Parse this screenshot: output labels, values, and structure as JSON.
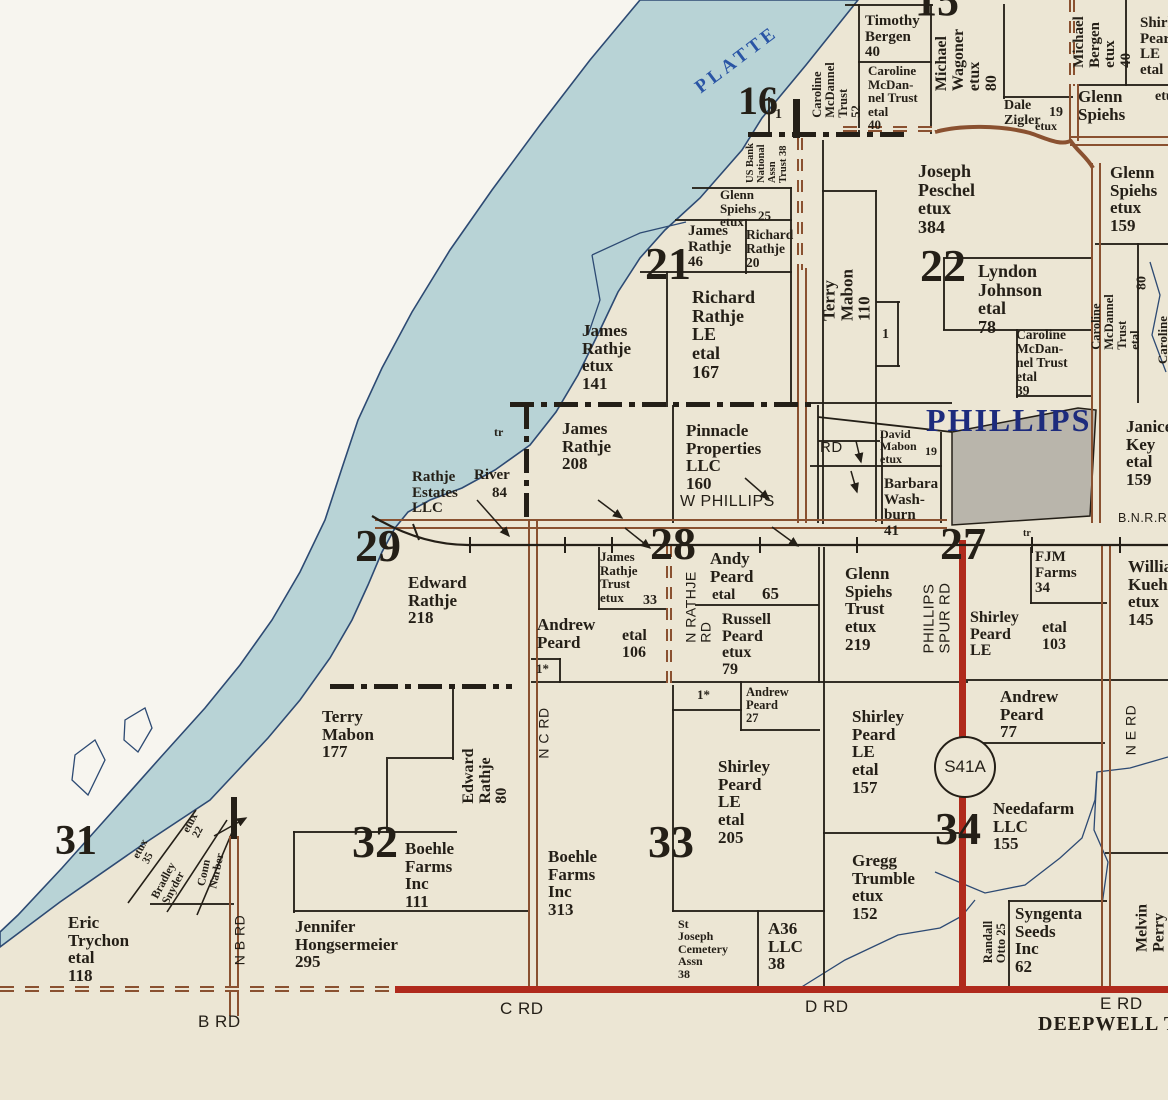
{
  "colors": {
    "paper": "#ece6d4",
    "margin": "#f7f5ef",
    "river": "#b8d3d6",
    "river-edge": "#2d4a73",
    "ink": "#241f17",
    "brown": "#8a5130",
    "red": "#b02a1c",
    "town": "#b9b5ab",
    "navy": "#1d2b7d",
    "platte": "#2a55a5"
  },
  "highway_shield": {
    "label": "S41A"
  },
  "river_name": "PLATTE",
  "town_name": "PHILLIPS",
  "railroad_label": "B.N.R.R.",
  "township_label": "DEEPWELL TW",
  "labels": [
    {
      "n": "river-name-platte",
      "t": "PLATTE",
      "x": 737,
      "y": 60,
      "fs": 19,
      "r": -37,
      "ls": 4,
      "c": "#2a55a5"
    },
    {
      "n": "town-name-phillips",
      "t": "PHILLIPS",
      "x": 926,
      "y": 404,
      "fs": 32,
      "ls": 2,
      "c": "#1d2b7d"
    },
    {
      "n": "railroad-label",
      "t": "B.N.R.R.",
      "x": 1118,
      "y": 512,
      "fs": 12.5,
      "f": "sans"
    },
    {
      "n": "section-number-15",
      "t": "15",
      "x": 915,
      "y": -22,
      "fs": 44
    },
    {
      "n": "section-number-16",
      "t": "16",
      "x": 738,
      "y": 80,
      "fs": 40
    },
    {
      "n": "section-number-21",
      "t": "21",
      "x": 645,
      "y": 240,
      "fs": 46
    },
    {
      "n": "section-number-22",
      "t": "22",
      "x": 920,
      "y": 242,
      "fs": 46
    },
    {
      "n": "section-number-27",
      "t": "27",
      "x": 940,
      "y": 520,
      "fs": 46
    },
    {
      "n": "section-number-28",
      "t": "28",
      "x": 650,
      "y": 520,
      "fs": 46
    },
    {
      "n": "section-number-29",
      "t": "29",
      "x": 355,
      "y": 522,
      "fs": 46
    },
    {
      "n": "section-number-31",
      "t": "31",
      "x": 55,
      "y": 820,
      "fs": 42
    },
    {
      "n": "section-number-32",
      "t": "32",
      "x": 352,
      "y": 818,
      "fs": 46
    },
    {
      "n": "section-number-33",
      "t": "33",
      "x": 648,
      "y": 818,
      "fs": 46
    },
    {
      "n": "section-number-34",
      "t": "34",
      "x": 935,
      "y": 805,
      "fs": 46
    },
    {
      "t": "Timothy\nBergen\n40",
      "x": 865,
      "y": 14,
      "fs": 15
    },
    {
      "t": "Caroline\nMcDan-\nnel Trust\netal\n40",
      "x": 868,
      "y": 64,
      "fs": 13
    },
    {
      "t": "Michael\nWagoner\netux\n80",
      "x": 967,
      "y": 60,
      "fs": 16,
      "r": -90
    },
    {
      "t": "Dale\nZigler",
      "x": 1004,
      "y": 99,
      "fs": 14
    },
    {
      "t": "19",
      "x": 1049,
      "y": 106,
      "fs": 14
    },
    {
      "t": "etux",
      "x": 1035,
      "y": 120,
      "fs": 12
    },
    {
      "t": "Michael\nBergen\netux\n40",
      "x": 1103,
      "y": 42,
      "fs": 15,
      "r": -90
    },
    {
      "t": "Shirley\nPeard\nLE\netal",
      "x": 1140,
      "y": 16,
      "fs": 15
    },
    {
      "t": "Glenn\nSpiehs",
      "x": 1078,
      "y": 88,
      "fs": 17
    },
    {
      "t": "etux",
      "x": 1155,
      "y": 90,
      "fs": 14
    },
    {
      "t": "Caroline\nMcDannel\nTrust\n52",
      "x": 837,
      "y": 90,
      "fs": 12.5,
      "r": -90
    },
    {
      "t": "US Bank\nNational\nAssn\nTrust 38",
      "x": 768,
      "y": 163,
      "fs": 10.5,
      "r": -90
    },
    {
      "t": "1",
      "x": 775,
      "y": 108,
      "fs": 14
    },
    {
      "t": "Glenn\nSpiehs\netux",
      "x": 720,
      "y": 188,
      "fs": 13
    },
    {
      "t": "25",
      "x": 758,
      "y": 209,
      "fs": 13
    },
    {
      "t": "James\nRathje\n46",
      "x": 688,
      "y": 224,
      "fs": 15
    },
    {
      "t": "Richard\nRathje\n20",
      "x": 746,
      "y": 228,
      "fs": 13.5
    },
    {
      "t": "Terry\nMabon\n110",
      "x": 847,
      "y": 295,
      "fs": 17,
      "r": -90
    },
    {
      "t": "1",
      "x": 882,
      "y": 328,
      "fs": 14
    },
    {
      "t": "Joseph\nPeschel\netux\n384",
      "x": 918,
      "y": 162,
      "fs": 18
    },
    {
      "t": "Glenn\nSpiehs\netux\n159",
      "x": 1110,
      "y": 164,
      "fs": 17
    },
    {
      "t": "Lyndon\nJohnson\netal\n78",
      "x": 978,
      "y": 262,
      "fs": 18
    },
    {
      "t": "Caroline\nMcDan-\nnel Trust\netal\n39",
      "x": 1016,
      "y": 328,
      "fs": 13.5
    },
    {
      "t": "Caroline\nMcDannel\nTrust\netal",
      "x": 1116,
      "y": 322,
      "fs": 12.5,
      "r": -90
    },
    {
      "t": "80",
      "x": 1143,
      "y": 283,
      "fs": 14,
      "r": -90
    },
    {
      "t": "Caroline",
      "x": 1163,
      "y": 340,
      "fs": 13,
      "r": -90
    },
    {
      "t": "Richard\nRathje\nLE\netal\n167",
      "x": 692,
      "y": 288,
      "fs": 18
    },
    {
      "t": "James\nRathje\netux\n141",
      "x": 582,
      "y": 322,
      "fs": 17
    },
    {
      "t": "James\nRathje\n208",
      "x": 562,
      "y": 420,
      "fs": 17
    },
    {
      "t": "Pinnacle\nProperties\nLLC\n160",
      "x": 686,
      "y": 422,
      "fs": 17
    },
    {
      "t": "W PHILLIPS",
      "x": 680,
      "y": 494,
      "fs": 16,
      "f": "sans"
    },
    {
      "t": "tr",
      "x": 494,
      "y": 426,
      "fs": 12
    },
    {
      "t": "tr",
      "x": 1023,
      "y": 529,
      "fs": 10
    },
    {
      "t": "RD",
      "x": 820,
      "y": 440,
      "fs": 15,
      "f": "sans"
    },
    {
      "t": "David\nMabon\netux",
      "x": 880,
      "y": 428,
      "fs": 12
    },
    {
      "t": "19",
      "x": 925,
      "y": 445,
      "fs": 12
    },
    {
      "t": "Barbara\nWash-\nburn\n41",
      "x": 884,
      "y": 477,
      "fs": 15
    },
    {
      "t": "Janice\nKey\netal\n159",
      "x": 1126,
      "y": 418,
      "fs": 17
    },
    {
      "t": "Rathje\nEstates\nLLC",
      "x": 412,
      "y": 470,
      "fs": 15
    },
    {
      "t": "River",
      "x": 474,
      "y": 468,
      "fs": 15
    },
    {
      "t": "84",
      "x": 492,
      "y": 486,
      "fs": 15
    },
    {
      "t": "Edward\nRathje\n218",
      "x": 408,
      "y": 574,
      "fs": 17
    },
    {
      "t": "James\nRathje\nTrust\netux",
      "x": 600,
      "y": 550,
      "fs": 13
    },
    {
      "t": "33",
      "x": 643,
      "y": 594,
      "fs": 14
    },
    {
      "t": "N RATHJE\nRD",
      "x": 698,
      "y": 607,
      "fs": 14,
      "f": "sans",
      "r": -90
    },
    {
      "t": "Andy\nPeard",
      "x": 710,
      "y": 550,
      "fs": 17
    },
    {
      "t": "etal",
      "x": 712,
      "y": 588,
      "fs": 15
    },
    {
      "t": "65",
      "x": 762,
      "y": 585,
      "fs": 17
    },
    {
      "t": "Russell\nPeard\netux\n79",
      "x": 722,
      "y": 612,
      "fs": 16
    },
    {
      "t": "Andrew\nPeard",
      "x": 537,
      "y": 616,
      "fs": 17
    },
    {
      "t": "etal\n106",
      "x": 622,
      "y": 628,
      "fs": 16
    },
    {
      "t": "1*",
      "x": 536,
      "y": 662,
      "fs": 13
    },
    {
      "t": "Glenn\nSpiehs\nTrust\netux\n219",
      "x": 845,
      "y": 565,
      "fs": 17
    },
    {
      "t": "PHILLIPS\nSPUR RD",
      "x": 937,
      "y": 618,
      "fs": 15,
      "f": "sans",
      "r": -90
    },
    {
      "t": "Shirley\nPeard\nLE",
      "x": 970,
      "y": 610,
      "fs": 16
    },
    {
      "t": "etal\n103",
      "x": 1042,
      "y": 620,
      "fs": 16
    },
    {
      "t": "FJM\nFarms\n34",
      "x": 1035,
      "y": 550,
      "fs": 15
    },
    {
      "t": "William\nKuehner\netux\n145",
      "x": 1128,
      "y": 558,
      "fs": 17
    },
    {
      "t": "Terry\nMabon\n177",
      "x": 322,
      "y": 708,
      "fs": 17
    },
    {
      "t": "Edward\nRathje\n80",
      "x": 486,
      "y": 776,
      "fs": 16,
      "r": -90
    },
    {
      "t": "N C RD",
      "x": 544,
      "y": 733,
      "fs": 14,
      "f": "sans",
      "r": -90
    },
    {
      "t": "Boehle\nFarms\nInc\n111",
      "x": 405,
      "y": 840,
      "fs": 17
    },
    {
      "t": "Jennifer\nHongsermeier\n295",
      "x": 295,
      "y": 918,
      "fs": 17
    },
    {
      "t": "Eric\nTrychon\netal\n118",
      "x": 68,
      "y": 914,
      "fs": 17
    },
    {
      "t": "etux\n35",
      "x": 146,
      "y": 852,
      "fs": 11,
      "r": -62
    },
    {
      "t": "Bradley\nSnyder",
      "x": 170,
      "y": 884,
      "fs": 11.5,
      "r": -62
    },
    {
      "t": "etux\n22",
      "x": 196,
      "y": 826,
      "fs": 11,
      "r": -62
    },
    {
      "t": "Conn\nNarber",
      "x": 212,
      "y": 870,
      "fs": 11.5,
      "r": -78
    },
    {
      "t": "N B RD",
      "x": 240,
      "y": 940,
      "fs": 14,
      "f": "sans",
      "r": -90
    },
    {
      "n": "road-label-b-rd",
      "t": "B RD",
      "x": 198,
      "y": 1013,
      "fs": 17,
      "f": "sans"
    },
    {
      "t": "Boehle\nFarms\nInc\n313",
      "x": 548,
      "y": 848,
      "fs": 17
    },
    {
      "t": "1*",
      "x": 697,
      "y": 688,
      "fs": 13
    },
    {
      "t": "Andrew\nPeard\n27",
      "x": 746,
      "y": 686,
      "fs": 12.5
    },
    {
      "t": "Shirley\nPeard\nLE\netal\n205",
      "x": 718,
      "y": 758,
      "fs": 17
    },
    {
      "t": "St\nJoseph\nCemetery\nAssn\n38",
      "x": 678,
      "y": 918,
      "fs": 12
    },
    {
      "t": "A36\nLLC\n38",
      "x": 768,
      "y": 920,
      "fs": 17
    },
    {
      "t": "Shirley\nPeard\nLE\netal\n157",
      "x": 852,
      "y": 708,
      "fs": 17
    },
    {
      "t": "Gregg\nTrumble\netux\n152",
      "x": 852,
      "y": 852,
      "fs": 17
    },
    {
      "n": "road-label-c-rd",
      "t": "C RD",
      "x": 500,
      "y": 1000,
      "fs": 17,
      "f": "sans"
    },
    {
      "n": "road-label-d-rd",
      "t": "D RD",
      "x": 805,
      "y": 998,
      "fs": 17,
      "f": "sans"
    },
    {
      "n": "road-label-e-rd",
      "t": "E RD",
      "x": 1100,
      "y": 995,
      "fs": 17,
      "f": "sans"
    },
    {
      "n": "township-label",
      "t": "DEEPWELL TW",
      "x": 1038,
      "y": 1014,
      "fs": 20,
      "ls": 1
    },
    {
      "t": "Andrew\nPeard\n77",
      "x": 1000,
      "y": 688,
      "fs": 17
    },
    {
      "t": "Needafarm\nLLC\n155",
      "x": 993,
      "y": 800,
      "fs": 17
    },
    {
      "t": "Randall\nOtto 25",
      "x": 995,
      "y": 942,
      "fs": 12.5,
      "r": -90
    },
    {
      "t": "Syngenta\nSeeds\nInc\n62",
      "x": 1015,
      "y": 905,
      "fs": 17
    },
    {
      "t": "Melvin\nPerry",
      "x": 1151,
      "y": 928,
      "fs": 16,
      "r": -90
    },
    {
      "t": "N E RD",
      "x": 1131,
      "y": 730,
      "fs": 14,
      "f": "sans",
      "r": -90
    }
  ],
  "lines": [
    [
      845,
      4,
      88,
      2
    ],
    [
      858,
      4,
      2,
      130
    ],
    [
      930,
      4,
      2,
      130
    ],
    [
      1003,
      4,
      2,
      95
    ],
    [
      1003,
      96,
      70,
      2
    ],
    [
      858,
      61,
      74,
      2
    ],
    [
      1125,
      0,
      2,
      86
    ],
    [
      1078,
      84,
      90,
      2
    ],
    [
      822,
      140,
      2,
      384
    ],
    [
      875,
      190,
      2,
      332
    ],
    [
      822,
      190,
      55,
      2
    ],
    [
      876,
      301,
      24,
      2
    ],
    [
      876,
      365,
      24,
      2
    ],
    [
      897,
      301,
      2,
      66
    ],
    [
      943,
      258,
      2,
      72
    ],
    [
      943,
      257,
      149,
      2
    ],
    [
      943,
      329,
      149,
      2
    ],
    [
      1016,
      329,
      2,
      69
    ],
    [
      1016,
      395,
      76,
      2
    ],
    [
      1095,
      243,
      73,
      2
    ],
    [
      1137,
      243,
      2,
      160
    ],
    [
      675,
      219,
      117,
      2
    ],
    [
      692,
      187,
      100,
      2
    ],
    [
      745,
      219,
      2,
      55
    ],
    [
      640,
      271,
      152,
      2
    ],
    [
      666,
      271,
      2,
      136
    ],
    [
      790,
      187,
      2,
      218
    ],
    [
      768,
      97,
      2,
      40
    ],
    [
      672,
      405,
      2,
      118
    ],
    [
      817,
      405,
      2,
      118
    ],
    [
      810,
      402,
      142,
      2
    ],
    [
      818,
      440,
      62,
      2
    ],
    [
      810,
      465,
      132,
      2
    ],
    [
      881,
      432,
      2,
      92
    ],
    [
      940,
      432,
      2,
      91
    ],
    [
      598,
      547,
      2,
      63
    ],
    [
      598,
      608,
      72,
      2
    ],
    [
      695,
      604,
      124,
      2
    ],
    [
      818,
      547,
      2,
      136
    ],
    [
      531,
      658,
      30,
      2
    ],
    [
      559,
      658,
      2,
      25
    ],
    [
      531,
      681,
      437,
      2
    ],
    [
      963,
      679,
      205,
      2
    ],
    [
      823,
      547,
      2,
      446
    ],
    [
      740,
      681,
      2,
      50
    ],
    [
      740,
      729,
      80,
      2
    ],
    [
      672,
      709,
      70,
      2
    ],
    [
      1030,
      547,
      2,
      57
    ],
    [
      1030,
      602,
      77,
      2
    ],
    [
      963,
      742,
      142,
      2
    ],
    [
      823,
      832,
      140,
      2
    ],
    [
      293,
      831,
      164,
      2
    ],
    [
      293,
      831,
      2,
      82
    ],
    [
      293,
      910,
      237,
      2
    ],
    [
      452,
      685,
      2,
      75
    ],
    [
      388,
      757,
      66,
      2
    ],
    [
      386,
      757,
      2,
      76
    ],
    [
      672,
      685,
      2,
      227
    ],
    [
      672,
      910,
      153,
      2
    ],
    [
      757,
      910,
      2,
      83
    ],
    [
      1008,
      900,
      99,
      2
    ],
    [
      1008,
      900,
      2,
      93
    ],
    [
      1105,
      852,
      63,
      2
    ],
    [
      150,
      903,
      84,
      2
    ]
  ],
  "bars": [
    [
      231,
      797,
      6,
      42
    ],
    [
      793,
      99,
      7,
      39
    ]
  ],
  "dashdot": [
    {
      "o": "h",
      "x": 510,
      "y": 402,
      "l": 308
    },
    {
      "o": "v",
      "x": 524,
      "y": 405,
      "l": 118
    },
    {
      "o": "h",
      "x": 330,
      "y": 684,
      "l": 182
    },
    {
      "o": "h",
      "x": 748,
      "y": 132,
      "l": 158
    }
  ],
  "roads": [
    {
      "t": "rrv",
      "x": 959,
      "y": 540,
      "l": 452
    },
    {
      "t": "rrh",
      "x": 395,
      "y": 986,
      "l": 773
    },
    {
      "t": "rbv",
      "x": 528,
      "y": 521,
      "l": 467
    },
    {
      "t": "rbv",
      "x": 797,
      "y": 268,
      "l": 255
    },
    {
      "t": "rbv",
      "x": 1091,
      "y": 163,
      "l": 360
    },
    {
      "t": "rbv",
      "x": 1069,
      "y": 84,
      "l": 57
    },
    {
      "t": "rbv",
      "x": 1101,
      "y": 545,
      "l": 443
    },
    {
      "t": "rbv",
      "x": 229,
      "y": 836,
      "l": 180
    },
    {
      "t": "rbh",
      "x": 375,
      "y": 519,
      "l": 572
    },
    {
      "t": "rbh",
      "x": 1070,
      "y": 136,
      "l": 98
    },
    {
      "t": "rbvd",
      "x": 666,
      "y": 545,
      "l": 138
    },
    {
      "t": "rbvd",
      "x": 797,
      "y": 138,
      "l": 132
    },
    {
      "t": "rbvd",
      "x": 1069,
      "y": 0,
      "l": 86
    },
    {
      "t": "rbhd",
      "x": 843,
      "y": 126,
      "l": 94
    },
    {
      "t": "rbhd",
      "x": 0,
      "y": 986,
      "l": 397
    }
  ]
}
